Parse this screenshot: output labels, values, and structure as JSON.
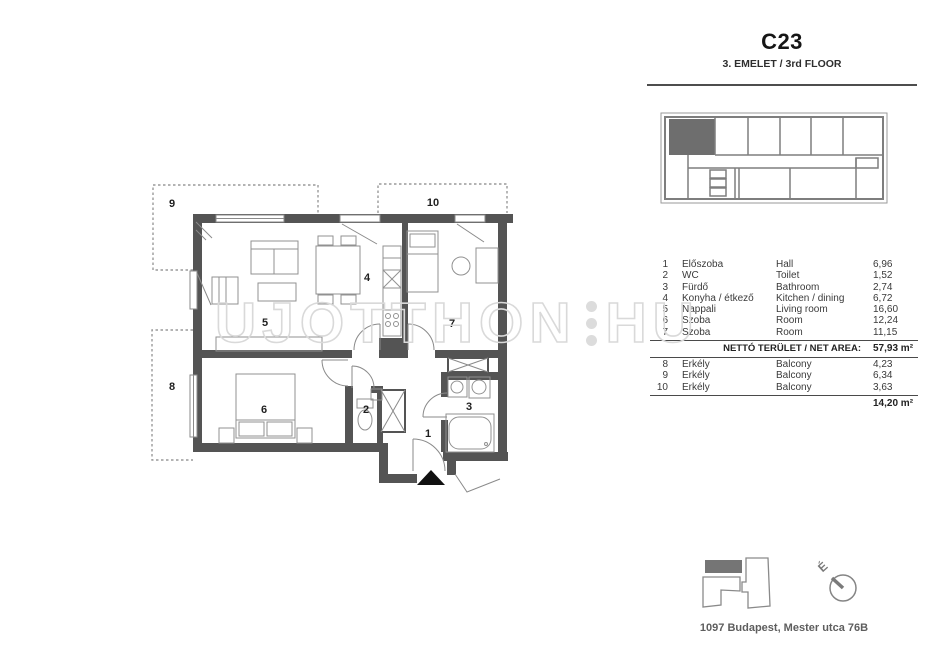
{
  "header": {
    "unit_code": "C23",
    "floor_label": "3. EMELET / 3rd FLOOR"
  },
  "plan": {
    "room_numbers": [
      "1",
      "2",
      "3",
      "4",
      "5",
      "6",
      "7",
      "8",
      "9",
      "10"
    ]
  },
  "legend": {
    "rows": [
      {
        "num": "1",
        "name_hu": "Előszoba",
        "name_en": "Hall",
        "area": "6,96"
      },
      {
        "num": "2",
        "name_hu": "WC",
        "name_en": "Toilet",
        "area": "1,52"
      },
      {
        "num": "3",
        "name_hu": "Fürdő",
        "name_en": "Bathroom",
        "area": "2,74"
      },
      {
        "num": "4",
        "name_hu": "Konyha / étkező",
        "name_en": "Kitchen / dining",
        "area": "6,72"
      },
      {
        "num": "5",
        "name_hu": "Nappali",
        "name_en": "Living room",
        "area": "16,60"
      },
      {
        "num": "6",
        "name_hu": "Szoba",
        "name_en": "Room",
        "area": "12,24"
      },
      {
        "num": "7",
        "name_hu": "Szoba",
        "name_en": "Room",
        "area": "11,15"
      }
    ],
    "net_label": "NETTÓ TERÜLET / NET AREA:",
    "net_area": "57,93 m²",
    "balcony_rows": [
      {
        "num": "8",
        "name_hu": "Erkély",
        "name_en": "Balcony",
        "area": "4,23"
      },
      {
        "num": "9",
        "name_hu": "Erkély",
        "name_en": "Balcony",
        "area": "6,34"
      },
      {
        "num": "10",
        "name_hu": "Erkély",
        "name_en": "Balcony",
        "area": "3,63"
      }
    ],
    "balcony_total": "14,20 m²"
  },
  "footer": {
    "address": "1097 Budapest, Mester utca 76B",
    "compass_north": "É"
  },
  "watermark": {
    "text": "UJOTTHON",
    "suffix": "HU"
  },
  "colors": {
    "wall": "#545454",
    "furniture": "#919191",
    "watermark": "#d9d9d9",
    "highlight_unit": "#6e6e6e"
  }
}
